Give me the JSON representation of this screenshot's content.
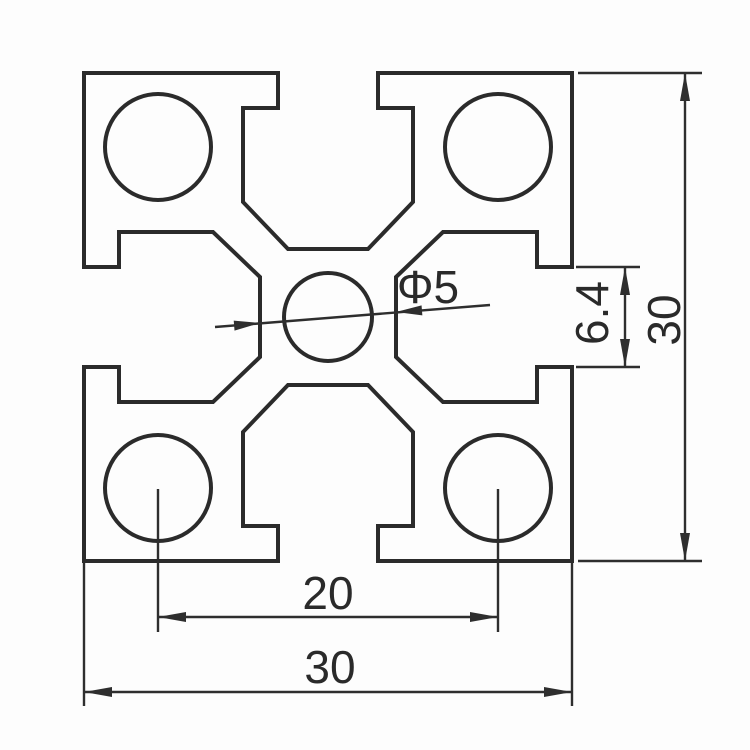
{
  "drawing": {
    "kind": "technical-drawing",
    "subject": "aluminum-extrusion-t-slot-profile-cross-section",
    "colors": {
      "background": "#fdfdfd",
      "line": "#2b2b2b",
      "text": "#2a2a2a"
    },
    "labels": {
      "bore_spacing_bottom": "20",
      "overall_width_bottom": "30",
      "overall_height_right": "30",
      "slot_opening_right": "6.4",
      "center_bore_diameter": "Φ5"
    }
  }
}
